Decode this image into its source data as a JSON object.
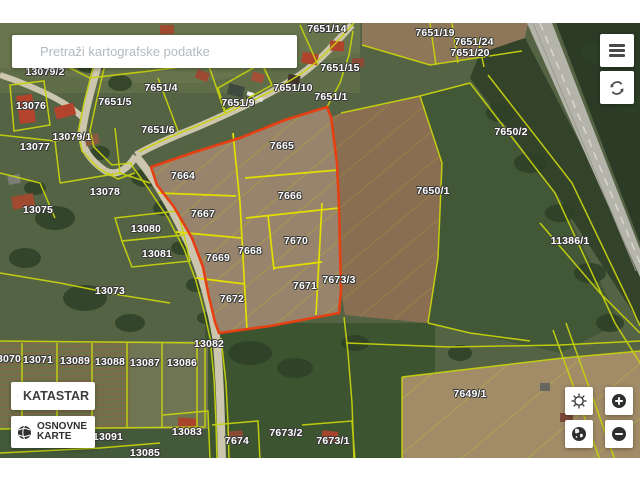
{
  "search": {
    "placeholder": "Pretraži kartografske podatke"
  },
  "layer_buttons": {
    "katastar": "KATASTAR",
    "osnovne_line1": "OSNOVNE",
    "osnovne_line2": "KARTE"
  },
  "colors": {
    "selection_red": "#e63f12",
    "parcel_line_yellow": "#c6d20e",
    "parcel_line_bright": "#e2df00",
    "hatch_olive": "#b3ab2e"
  },
  "map": {
    "parcel_labels": [
      {
        "text": "7651/14",
        "x": 327,
        "y": 29
      },
      {
        "text": "7651/19",
        "x": 435,
        "y": 33
      },
      {
        "text": "7651/24",
        "x": 474,
        "y": 42
      },
      {
        "text": "7651/20",
        "x": 470,
        "y": 53
      },
      {
        "text": "7651/15",
        "x": 340,
        "y": 68
      },
      {
        "text": "7651/10",
        "x": 293,
        "y": 88
      },
      {
        "text": "7651/1",
        "x": 331,
        "y": 97
      },
      {
        "text": "7651/4",
        "x": 161,
        "y": 88
      },
      {
        "text": "7651/9",
        "x": 238,
        "y": 103
      },
      {
        "text": "7651/5",
        "x": 115,
        "y": 102
      },
      {
        "text": "7651/6",
        "x": 158,
        "y": 130
      },
      {
        "text": "13079/2",
        "x": 45,
        "y": 72
      },
      {
        "text": "13076",
        "x": 31,
        "y": 106
      },
      {
        "text": "13079/1",
        "x": 72,
        "y": 137
      },
      {
        "text": "13077",
        "x": 35,
        "y": 147
      },
      {
        "text": "13078",
        "x": 105,
        "y": 192
      },
      {
        "text": "13075",
        "x": 38,
        "y": 210
      },
      {
        "text": "13080",
        "x": 146,
        "y": 229
      },
      {
        "text": "13081",
        "x": 157,
        "y": 254
      },
      {
        "text": "13073",
        "x": 110,
        "y": 291
      },
      {
        "text": "7664",
        "x": 183,
        "y": 176
      },
      {
        "text": "7665",
        "x": 282,
        "y": 146
      },
      {
        "text": "7666",
        "x": 290,
        "y": 196
      },
      {
        "text": "7667",
        "x": 203,
        "y": 214
      },
      {
        "text": "7668",
        "x": 250,
        "y": 251
      },
      {
        "text": "7669",
        "x": 218,
        "y": 258
      },
      {
        "text": "7670",
        "x": 296,
        "y": 241
      },
      {
        "text": "7671",
        "x": 305,
        "y": 286
      },
      {
        "text": "7672",
        "x": 232,
        "y": 299
      },
      {
        "text": "7673/3",
        "x": 339,
        "y": 280
      },
      {
        "text": "7650/2",
        "x": 511,
        "y": 132
      },
      {
        "text": "7650/1",
        "x": 433,
        "y": 191
      },
      {
        "text": "11386/1",
        "x": 570,
        "y": 241
      },
      {
        "text": "13082",
        "x": 209,
        "y": 344
      },
      {
        "text": "13070",
        "x": 6,
        "y": 359
      },
      {
        "text": "13071",
        "x": 38,
        "y": 360
      },
      {
        "text": "13089",
        "x": 75,
        "y": 361
      },
      {
        "text": "13088",
        "x": 110,
        "y": 362
      },
      {
        "text": "13087",
        "x": 145,
        "y": 363
      },
      {
        "text": "13086",
        "x": 182,
        "y": 363
      },
      {
        "text": "13091",
        "x": 108,
        "y": 437
      },
      {
        "text": "13083",
        "x": 187,
        "y": 432
      },
      {
        "text": "13085",
        "x": 145,
        "y": 453
      },
      {
        "text": "7674",
        "x": 237,
        "y": 441
      },
      {
        "text": "7673/2",
        "x": 286,
        "y": 433
      },
      {
        "text": "7673/1",
        "x": 333,
        "y": 441
      },
      {
        "text": "7649/1",
        "x": 470,
        "y": 394
      }
    ]
  }
}
